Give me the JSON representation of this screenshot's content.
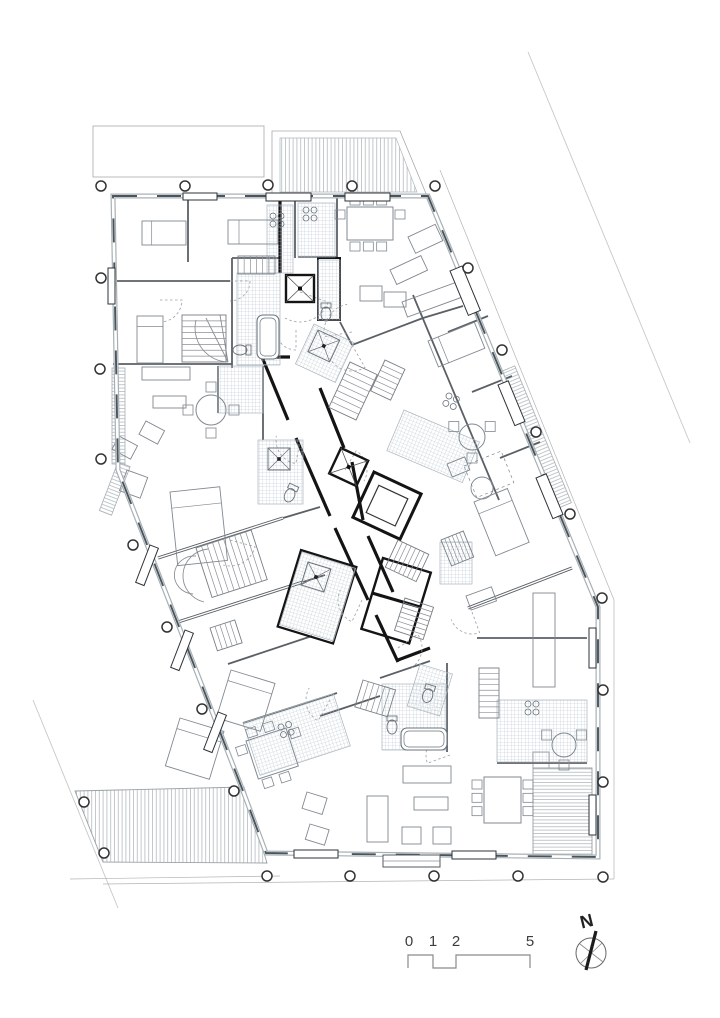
{
  "document": {
    "type": "architectural-floor-plan",
    "sheet": "apartment-building-storey-plan"
  },
  "colors": {
    "paper": "#ffffff",
    "site_line": "#c8c8c8",
    "outline_light": "#b4b4b4",
    "wall_band": "#a8b0b4",
    "wall_glass": "#49545c",
    "wall_gray": "#5a6066",
    "wall_light": "#8a9096",
    "wall_black": "#141414",
    "hatch": "#9fb0ba",
    "furniture": "#808890",
    "fixture": "#6a737b",
    "circle_stroke": "#333333",
    "text": "#3d3d3d"
  },
  "scalebar": {
    "labels": [
      {
        "t": "0",
        "x": 409,
        "y": 946
      },
      {
        "t": "1",
        "x": 433,
        "y": 946
      },
      {
        "t": "2",
        "x": 456,
        "y": 946
      },
      {
        "t": "5",
        "x": 530,
        "y": 946
      }
    ],
    "path": "M408,968 L408,955 L433,955 L433,968 L456,968 L456,955 L530,955 L530,968"
  },
  "north": {
    "label": "N",
    "lx": 588,
    "ly": 927,
    "rot": -14,
    "cx": 591,
    "cy": 953,
    "r": 15,
    "cross": [
      [
        580,
        944,
        603,
        962
      ],
      [
        581,
        963,
        602,
        943
      ]
    ],
    "needle": [
      596,
      931,
      586,
      970
    ]
  },
  "site_lines": [
    [
      528,
      52,
      690,
      443
    ],
    [
      33,
      700,
      118,
      908
    ]
  ],
  "offset_outline": [
    [
      440,
      170,
      614,
      600
    ],
    [
      614,
      600,
      614,
      879
    ],
    [
      614,
      879,
      103,
      884
    ],
    [
      70,
      879,
      280,
      876
    ]
  ],
  "footprint": "113,196 428,196 598,607 598,857 266,853 243,791 118,470",
  "top_left_rect": {
    "x": 93,
    "y": 126,
    "w": 171,
    "h": 51
  },
  "terraces": {
    "top_outer": "272,131 400,131 427,196 272,196",
    "top_hatch": "280,138 396,138 417,192 280,192",
    "bottom_left": "75,791 244,787 267,863 103,862",
    "bottom_right": "533,768 592,768 592,856 533,856",
    "br_notch": {
      "x": 533,
      "y": 752,
      "w": 16,
      "h": 16
    }
  },
  "loggias": [
    {
      "x": 112,
      "y": 368,
      "w": 13,
      "h": 96,
      "rot": 0
    },
    {
      "x": 118,
      "y": 462,
      "w": 13,
      "h": 52,
      "rot": 21
    },
    {
      "x": 500,
      "y": 372,
      "w": 16,
      "h": 148,
      "rot": -22.5
    }
  ],
  "walls_gray": [
    [
      188,
      196,
      188,
      262
    ],
    [
      115,
      281,
      230,
      281
    ],
    [
      232,
      258,
      232,
      368
    ],
    [
      232,
      258,
      280,
      258
    ],
    [
      113,
      364,
      232,
      364
    ],
    [
      295,
      196,
      295,
      258
    ],
    [
      337,
      196,
      337,
      257
    ],
    [
      298,
      257,
      337,
      257
    ],
    [
      352,
      345,
      423,
      318
    ],
    [
      423,
      318,
      463,
      306
    ],
    [
      340,
      322,
      352,
      345
    ],
    [
      218,
      366,
      218,
      413
    ],
    [
      263,
      366,
      263,
      440
    ],
    [
      413,
      295,
      499,
      500
    ],
    [
      448,
      332,
      488,
      316
    ],
    [
      472,
      392,
      512,
      376
    ],
    [
      500,
      458,
      540,
      442
    ],
    [
      477,
      638,
      587,
      638
    ],
    [
      447,
      663,
      447,
      752
    ],
    [
      380,
      678,
      430,
      661
    ],
    [
      320,
      716,
      380,
      696
    ],
    [
      243,
      723,
      337,
      693
    ],
    [
      228,
      664,
      312,
      636
    ],
    [
      497,
      763,
      587,
      763
    ],
    [
      283,
      518,
      320,
      507
    ],
    [
      303,
      582,
      325,
      575
    ]
  ],
  "walls_double": [
    [
      158,
      558,
      283,
      518
    ],
    [
      178,
      622,
      303,
      582
    ],
    [
      468,
      608,
      572,
      568
    ]
  ],
  "walls_black": [
    [
      280,
      196,
      280,
      273
    ],
    [
      262,
      357,
      288,
      420
    ],
    [
      296,
      438,
      330,
      516
    ],
    [
      335,
      528,
      368,
      600
    ],
    [
      376,
      615,
      398,
      662
    ],
    [
      320,
      388,
      344,
      448
    ],
    [
      352,
      462,
      363,
      520
    ],
    [
      368,
      536,
      393,
      592
    ],
    [
      398,
      660,
      430,
      648
    ],
    [
      262,
      357,
      290,
      357
    ],
    [
      372,
      593,
      420,
      607
    ]
  ],
  "black_rects": [
    {
      "x": 318,
      "y": 258,
      "w": 22,
      "h": 62,
      "rot": 0,
      "sw": 2
    },
    {
      "x": 301,
      "y": 550,
      "w": 58,
      "h": 80,
      "rot": 17,
      "sw": 2.2
    },
    {
      "x": 383,
      "y": 558,
      "w": 50,
      "h": 74,
      "rot": 17,
      "sw": 2.4
    }
  ],
  "elevators": [
    {
      "x": 286,
      "y": 275,
      "w": 28,
      "h": 27,
      "rot": 0
    },
    {
      "x": 341,
      "y": 448,
      "w": 30,
      "h": 28,
      "rot": 25
    }
  ],
  "shaft": {
    "x": 374,
    "y": 472,
    "w": 52,
    "h": 50,
    "rot": 25,
    "ix": 384,
    "iy": 482,
    "iw": 32,
    "ih": 30
  },
  "hatch_patches": [
    {
      "x": 267,
      "y": 205,
      "w": 26,
      "h": 68,
      "rot": 0
    },
    {
      "x": 237,
      "y": 273,
      "w": 43,
      "h": 92,
      "rot": 0
    },
    {
      "x": 298,
      "y": 203,
      "w": 37,
      "h": 54,
      "rot": 0
    },
    {
      "x": 318,
      "y": 260,
      "w": 22,
      "h": 60,
      "rot": 0
    },
    {
      "x": 218,
      "y": 366,
      "w": 45,
      "h": 47,
      "rot": 0
    },
    {
      "x": 258,
      "y": 440,
      "w": 45,
      "h": 64,
      "rot": 0
    },
    {
      "x": 314,
      "y": 324,
      "w": 44,
      "h": 44,
      "rot": 25
    },
    {
      "x": 404,
      "y": 410,
      "w": 82,
      "h": 44,
      "rot": 23
    },
    {
      "x": 302,
      "y": 552,
      "w": 56,
      "h": 76,
      "rot": 17
    },
    {
      "x": 420,
      "y": 664,
      "w": 34,
      "h": 44,
      "rot": 17
    },
    {
      "x": 382,
      "y": 684,
      "w": 64,
      "h": 66,
      "rot": 0
    },
    {
      "x": 497,
      "y": 700,
      "w": 90,
      "h": 62,
      "rot": 0
    },
    {
      "x": 243,
      "y": 723,
      "w": 95,
      "h": 55,
      "rot": -18
    },
    {
      "x": 440,
      "y": 542,
      "w": 32,
      "h": 42,
      "rot": 0
    }
  ],
  "stairs": [
    {
      "x": 238,
      "y": 256,
      "w": 37,
      "h": 18,
      "n": 6,
      "rot": 0,
      "vert": true
    },
    {
      "x": 182,
      "y": 315,
      "w": 44,
      "h": 47,
      "n": 8,
      "rot": 0,
      "vert": false
    },
    {
      "x": 350,
      "y": 362,
      "w": 30,
      "h": 50,
      "n": 8,
      "rot": 25,
      "vert": false
    },
    {
      "x": 385,
      "y": 360,
      "w": 22,
      "h": 34,
      "n": 6,
      "rot": 25,
      "vert": false
    },
    {
      "x": 398,
      "y": 540,
      "w": 34,
      "h": 30,
      "n": 7,
      "rot": 25,
      "vert": true
    },
    {
      "x": 405,
      "y": 598,
      "w": 30,
      "h": 34,
      "n": 7,
      "rot": 18,
      "vert": false
    },
    {
      "x": 196,
      "y": 548,
      "w": 58,
      "h": 52,
      "n": 10,
      "rot": -18,
      "vert": true
    },
    {
      "x": 363,
      "y": 680,
      "w": 34,
      "h": 28,
      "n": 6,
      "rot": 17,
      "vert": true
    },
    {
      "x": 479,
      "y": 668,
      "w": 20,
      "h": 50,
      "n": 9,
      "rot": 0,
      "vert": false
    },
    {
      "x": 441,
      "y": 540,
      "w": 24,
      "h": 28,
      "n": 6,
      "rot": -22,
      "vert": true
    },
    {
      "x": 210,
      "y": 628,
      "w": 26,
      "h": 24,
      "n": 5,
      "rot": -18,
      "vert": true
    }
  ],
  "extra_paths": [
    "M208,549 A28,27 0 0 0 204,602",
    "M196,556 A18,17 0 0 0 193,594",
    "M228,362 A34,34 0 0 1 196,320",
    "M228,362 L206,318",
    "M228,362 L220,315"
  ],
  "door_arcs": [
    {
      "x": 230,
      "y": 281,
      "r": 20,
      "a0": 0,
      "a1": 90
    },
    {
      "x": 296,
      "y": 330,
      "r": 20,
      "a0": 90,
      "a1": 180
    },
    {
      "x": 300,
      "y": 440,
      "r": 24,
      "a0": 100,
      "a1": 190
    },
    {
      "x": 345,
      "y": 470,
      "r": 22,
      "a0": -60,
      "a1": 30
    },
    {
      "x": 362,
      "y": 600,
      "r": 24,
      "a0": 115,
      "a1": 205
    },
    {
      "x": 398,
      "y": 648,
      "r": 24,
      "a0": -35,
      "a1": 55
    },
    {
      "x": 352,
      "y": 345,
      "r": 26,
      "a0": 60,
      "a1": 150
    },
    {
      "x": 230,
      "y": 540,
      "r": 26,
      "a0": 15,
      "a1": 105
    },
    {
      "x": 330,
      "y": 700,
      "r": 24,
      "a0": 120,
      "a1": 210
    },
    {
      "x": 450,
      "y": 755,
      "r": 24,
      "a0": 160,
      "a1": 250
    },
    {
      "x": 160,
      "y": 300,
      "r": 22,
      "a0": 0,
      "a1": 80
    },
    {
      "x": 472,
      "y": 612,
      "r": 22,
      "a0": 70,
      "a1": 160
    },
    {
      "x": 300,
      "y": 292,
      "r": 30,
      "a0": 20,
      "a1": 120
    },
    {
      "x": 352,
      "y": 332,
      "r": 28,
      "a0": 170,
      "a1": 260
    }
  ],
  "showers": [
    {
      "x": 268,
      "y": 448,
      "s": 22,
      "rot": 0
    },
    {
      "x": 318,
      "y": 330,
      "s": 24,
      "rot": 25
    },
    {
      "x": 308,
      "y": 562,
      "s": 24,
      "rot": 17
    }
  ],
  "tubs": [
    {
      "x": 257,
      "y": 315,
      "w": 22,
      "h": 44,
      "rot": 0
    },
    {
      "x": 401,
      "y": 728,
      "w": 46,
      "h": 22,
      "rot": 0
    }
  ],
  "toilets": [
    {
      "x": 248,
      "y": 350,
      "rot": 90
    },
    {
      "x": 293,
      "y": 488,
      "rot": 25
    },
    {
      "x": 392,
      "y": 719,
      "rot": 0
    },
    {
      "x": 326,
      "y": 306,
      "rot": 0
    },
    {
      "x": 430,
      "y": 688,
      "rot": 17
    }
  ],
  "stoves": [
    {
      "x": 273,
      "y": 216,
      "rot": 0
    },
    {
      "x": 306,
      "y": 210,
      "rot": 0
    },
    {
      "x": 449,
      "y": 396,
      "rot": 23
    },
    {
      "x": 528,
      "y": 704,
      "rot": 0
    },
    {
      "x": 281,
      "y": 727,
      "rot": -18
    }
  ],
  "beds": [
    {
      "x": 142,
      "y": 221,
      "w": 44,
      "h": 24,
      "rot": 0
    },
    {
      "x": 228,
      "y": 220,
      "w": 50,
      "h": 24,
      "rot": 0
    },
    {
      "x": 137,
      "y": 316,
      "w": 26,
      "h": 47,
      "rot": 0
    },
    {
      "x": 170,
      "y": 492,
      "w": 50,
      "h": 74,
      "rot": -6
    },
    {
      "x": 180,
      "y": 718,
      "w": 46,
      "h": 50,
      "rot": 17
    },
    {
      "x": 231,
      "y": 670,
      "w": 46,
      "h": 50,
      "rot": 17
    },
    {
      "x": 474,
      "y": 502,
      "w": 36,
      "h": 58,
      "rot": -22
    },
    {
      "x": 428,
      "y": 341,
      "w": 50,
      "h": 28,
      "rot": -22
    }
  ],
  "sofas": [
    {
      "x": 142,
      "y": 367,
      "w": 48,
      "h": 13,
      "rot": 0
    },
    {
      "x": 153,
      "y": 396,
      "w": 33,
      "h": 12,
      "rot": 0
    },
    {
      "x": 146,
      "y": 421,
      "w": 21,
      "h": 15,
      "rot": 28
    },
    {
      "x": 119,
      "y": 436,
      "w": 21,
      "h": 15,
      "rot": 28
    },
    {
      "x": 408,
      "y": 237,
      "w": 30,
      "h": 18,
      "rot": -25
    },
    {
      "x": 390,
      "y": 270,
      "w": 34,
      "h": 16,
      "rot": -25
    },
    {
      "x": 360,
      "y": 286,
      "w": 22,
      "h": 15,
      "rot": 0
    },
    {
      "x": 384,
      "y": 292,
      "w": 22,
      "h": 15,
      "rot": 0
    },
    {
      "x": 402,
      "y": 302,
      "w": 58,
      "h": 16,
      "rot": -20
    },
    {
      "x": 447,
      "y": 464,
      "w": 19,
      "h": 14,
      "rot": -22
    },
    {
      "x": 466,
      "y": 596,
      "w": 27,
      "h": 15,
      "rot": -20
    },
    {
      "x": 403,
      "y": 766,
      "w": 48,
      "h": 17,
      "rot": 0
    },
    {
      "x": 414,
      "y": 797,
      "w": 34,
      "h": 13,
      "rot": 0
    },
    {
      "x": 402,
      "y": 827,
      "w": 19,
      "h": 17,
      "rot": 0
    },
    {
      "x": 433,
      "y": 827,
      "w": 18,
      "h": 17,
      "rot": 0
    },
    {
      "x": 307,
      "y": 792,
      "w": 21,
      "h": 17,
      "rot": 17
    },
    {
      "x": 310,
      "y": 824,
      "w": 20,
      "h": 16,
      "rot": 17
    },
    {
      "x": 367,
      "y": 796,
      "w": 21,
      "h": 46,
      "rot": 0
    },
    {
      "x": 533,
      "y": 593,
      "w": 22,
      "h": 94,
      "rot": 0
    },
    {
      "x": 127,
      "y": 470,
      "w": 22,
      "h": 22,
      "rot": 20
    }
  ],
  "rug": {
    "x": 464,
    "y": 466,
    "w": 40,
    "h": 34,
    "rot": -22
  },
  "ottoman": {
    "cx": 482,
    "cy": 488,
    "r": 11
  },
  "round_tables": [
    {
      "cx": 211,
      "cy": 410,
      "r": 15,
      "n": 4
    },
    {
      "cx": 472,
      "cy": 437,
      "r": 13,
      "n": 3
    },
    {
      "cx": 564,
      "cy": 745,
      "r": 12,
      "n": 3
    }
  ],
  "rect_tables": [
    {
      "x": 347,
      "y": 207,
      "w": 46,
      "h": 33,
      "rot": 0,
      "top": 3,
      "bottom": 3,
      "left": 1,
      "right": 1
    },
    {
      "x": 484,
      "y": 777,
      "w": 37,
      "h": 46,
      "rot": 0,
      "top": 0,
      "bottom": 0,
      "left": 3,
      "right": 3
    },
    {
      "x": 246,
      "y": 741,
      "w": 42,
      "h": 40,
      "rot": -18,
      "top": 2,
      "bottom": 2,
      "left": 1,
      "right": 1
    }
  ],
  "window_frames": [
    {
      "x": 183,
      "y": 193,
      "w": 34,
      "h": 7,
      "rot": 0
    },
    {
      "x": 266,
      "y": 193,
      "w": 45,
      "h": 8,
      "rot": 0
    },
    {
      "x": 345,
      "y": 193,
      "w": 45,
      "h": 8,
      "rot": 0
    },
    {
      "x": 108,
      "y": 268,
      "w": 7,
      "h": 36,
      "rot": 0
    },
    {
      "x": 450,
      "y": 271,
      "w": 13,
      "h": 48,
      "rot": -22.5
    },
    {
      "x": 498,
      "y": 385,
      "w": 11,
      "h": 44,
      "rot": -22.5
    },
    {
      "x": 536,
      "y": 478,
      "w": 11,
      "h": 44,
      "rot": -22.5
    },
    {
      "x": 589,
      "y": 628,
      "w": 7,
      "h": 40,
      "rot": 0
    },
    {
      "x": 589,
      "y": 795,
      "w": 7,
      "h": 40,
      "rot": 0
    },
    {
      "x": 294,
      "y": 850,
      "w": 44,
      "h": 8,
      "rot": 0
    },
    {
      "x": 452,
      "y": 851,
      "w": 44,
      "h": 8,
      "rot": 0
    },
    {
      "x": 150,
      "y": 545,
      "w": 9,
      "h": 40,
      "rot": 21
    },
    {
      "x": 185,
      "y": 630,
      "w": 9,
      "h": 40,
      "rot": 21
    },
    {
      "x": 218,
      "y": 712,
      "w": 9,
      "h": 40,
      "rot": 21
    }
  ],
  "entrance_mat": {
    "x": 383,
    "y": 855,
    "w": 57,
    "h": 12
  },
  "circles": [
    [
      101,
      186
    ],
    [
      185,
      186
    ],
    [
      268,
      185
    ],
    [
      352,
      186
    ],
    [
      435,
      186
    ],
    [
      468,
      268
    ],
    [
      502,
      350
    ],
    [
      536,
      432
    ],
    [
      570,
      514
    ],
    [
      602,
      598
    ],
    [
      603,
      690
    ],
    [
      603,
      782
    ],
    [
      603,
      877
    ],
    [
      267,
      876
    ],
    [
      350,
      876
    ],
    [
      434,
      876
    ],
    [
      518,
      876
    ],
    [
      101,
      278
    ],
    [
      100,
      369
    ],
    [
      101,
      459
    ],
    [
      133,
      545
    ],
    [
      167,
      627
    ],
    [
      202,
      709
    ],
    [
      234,
      791
    ],
    [
      84,
      802
    ],
    [
      104,
      853
    ]
  ]
}
